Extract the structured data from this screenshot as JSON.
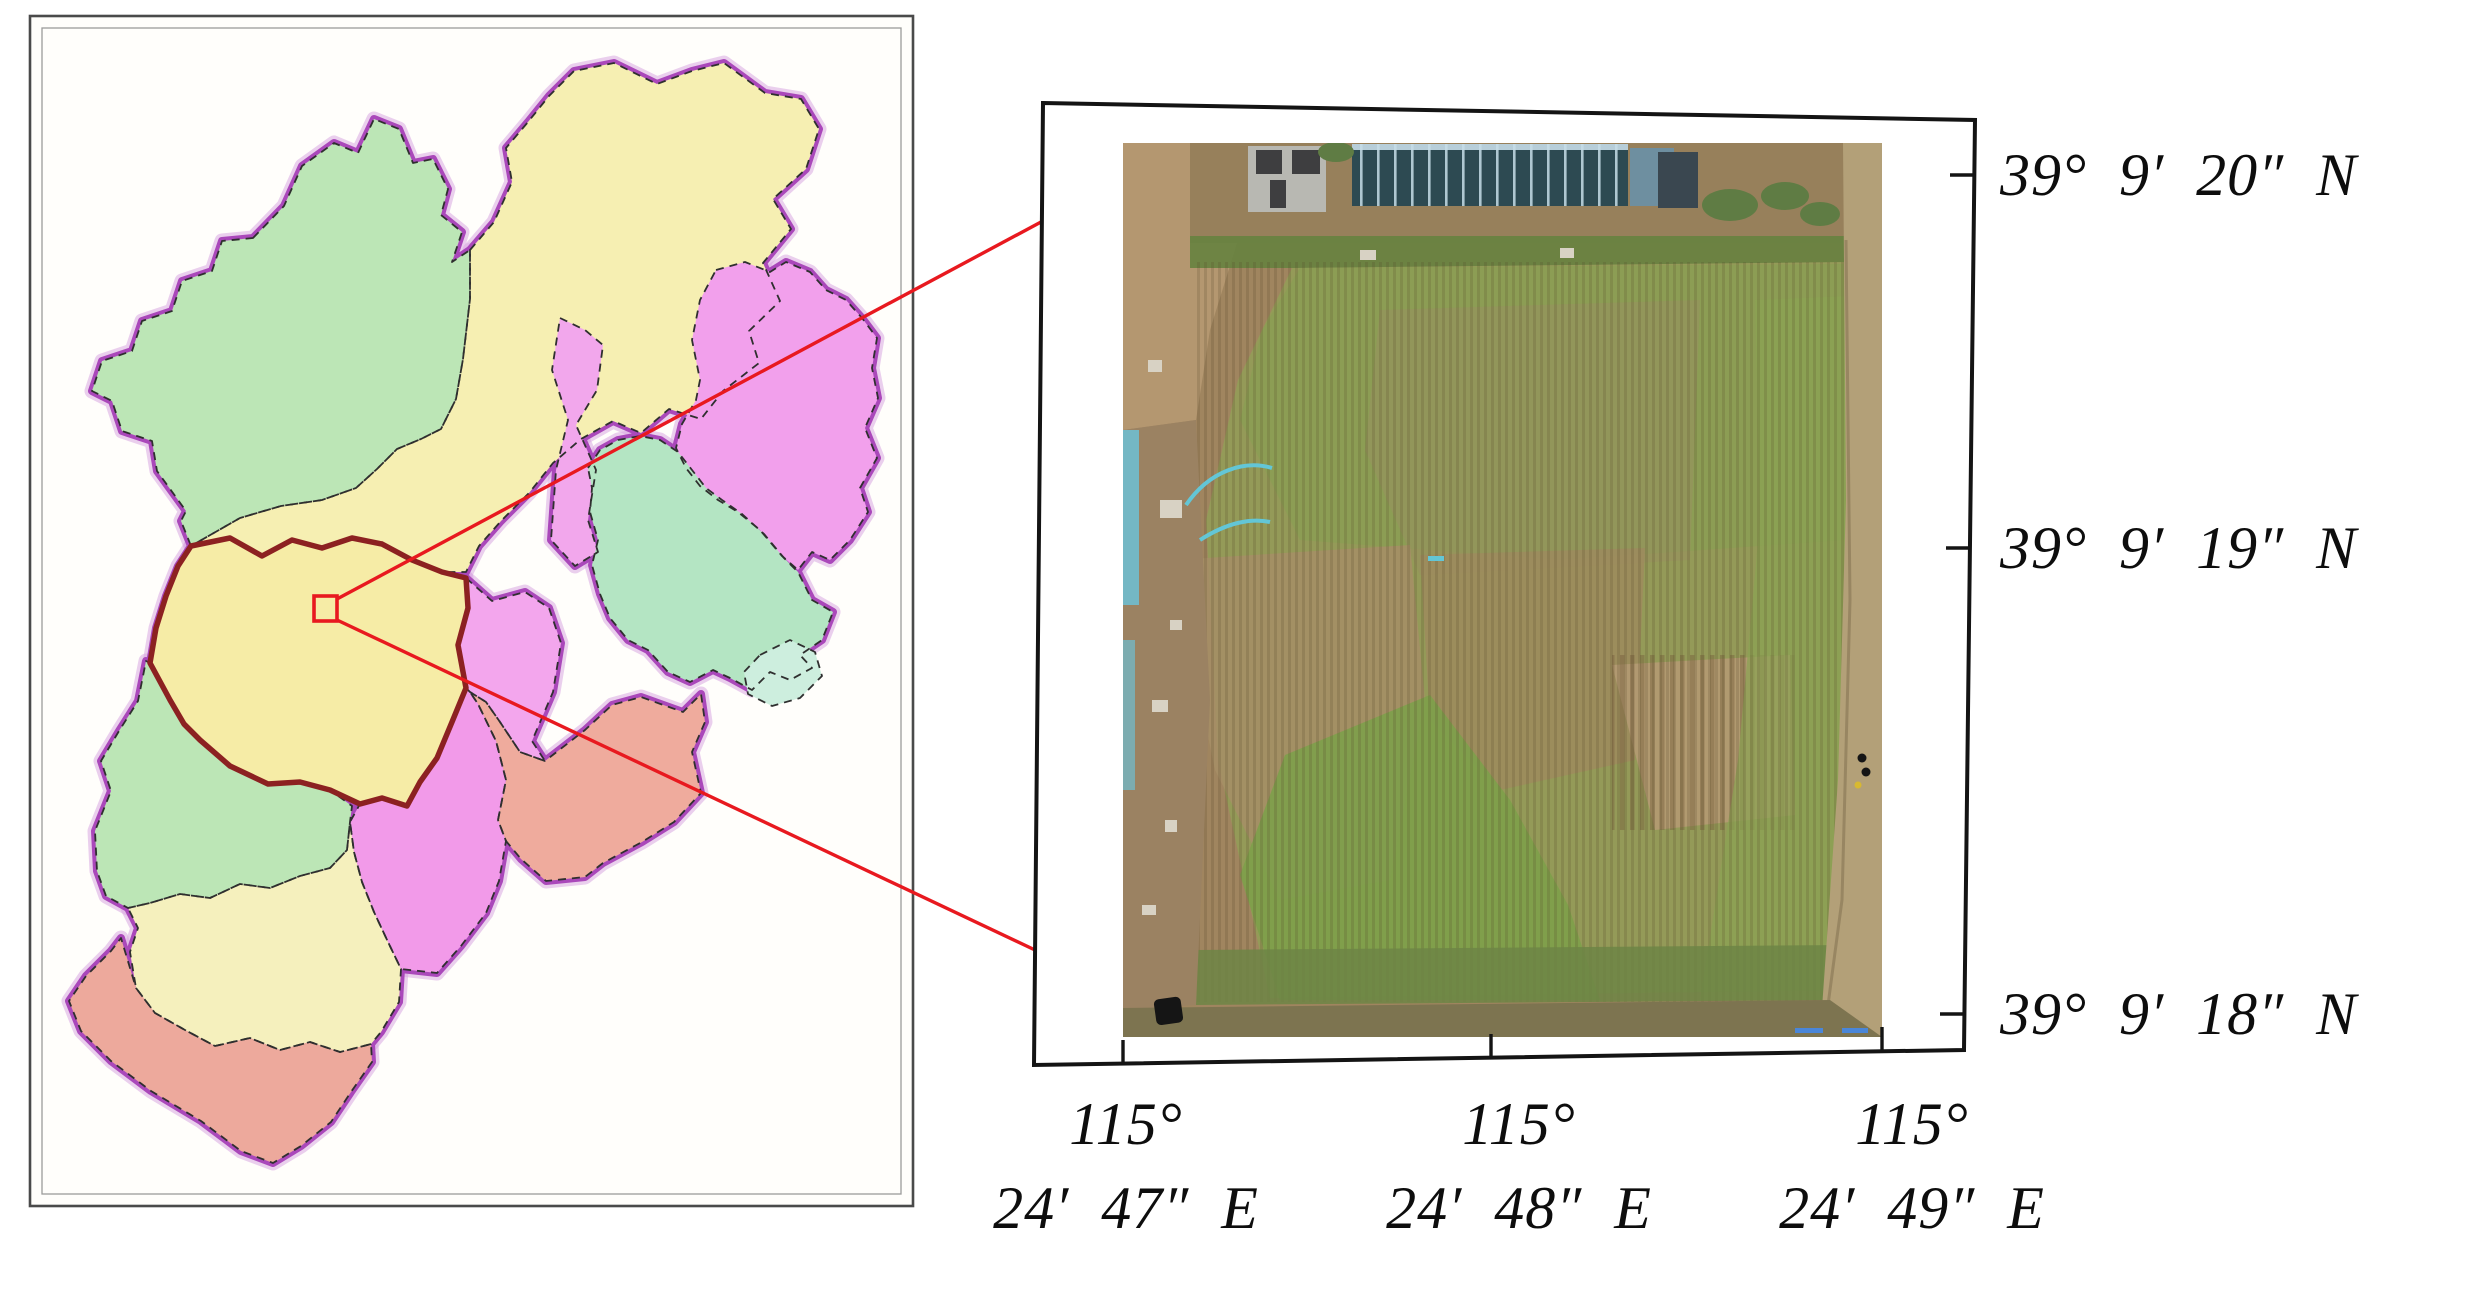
{
  "figure": {
    "kind": "study-area location figure",
    "left": "county administrative map with highlighted study county",
    "right": "UAV orthophoto of experimental field with coordinate grid"
  },
  "palette": {
    "boundary_purple": "#aa48ba",
    "boundary_halo": "#d9a8e2",
    "inner_border_dash": "#2f2f2f",
    "highlight_border": "#8c2121",
    "marker_red": "#e8191f",
    "frame_black": "#141414",
    "panel_border_outer": "#4a4a4a",
    "panel_border_inner": "#9b9b9b",
    "panel_fill": "#fffefb",
    "label_color": "#0d0d0d"
  },
  "left_map": {
    "regions": [
      {
        "id": "northwest-green",
        "color": "#bce6b6"
      },
      {
        "id": "north-yellow",
        "color": "#f6efb2"
      },
      {
        "id": "northeast-sliver-pink",
        "color": "#f2a7ec"
      },
      {
        "id": "northeast-pink",
        "color": "#f2a0ec"
      },
      {
        "id": "northeast-green",
        "color": "#b4e5c3"
      },
      {
        "id": "northeast-green-tail",
        "color": "#cdeede"
      },
      {
        "id": "highlight-yellow",
        "color": "#f6eca6"
      },
      {
        "id": "centereast-pink",
        "color": "#f3a6ed"
      },
      {
        "id": "east-salmon",
        "color": "#efab9d"
      },
      {
        "id": "central-magenta",
        "color": "#f29ae9"
      },
      {
        "id": "west-green",
        "color": "#bce6b6"
      },
      {
        "id": "southwest-yellow",
        "color": "#f5f0bd"
      },
      {
        "id": "south-salmon",
        "color": "#eda99c"
      }
    ]
  },
  "right_panel": {
    "lat_labels": [
      "39° 9′ 20″ N",
      "39° 9′ 19″ N",
      "39° 9′ 18″ N"
    ],
    "lon_labels": [
      {
        "line1": "115°",
        "line2": "24′ 47″ E"
      },
      {
        "line1": "115°",
        "line2": "24′ 48″ E"
      },
      {
        "line1": "115°",
        "line2": "24′ 49″ E"
      }
    ],
    "photo": {
      "dirt": "#a0855f",
      "dirt_light": "#b49770",
      "dirt_top": "#97805b",
      "weeds": "#66823f",
      "field": "#949a58",
      "field_top": "#8b9d54",
      "patch_brown": "#a68e66",
      "patch_brown2": "#9d8a5e",
      "plough": "#b29a72",
      "streak": "#98905e",
      "green_wedge": "#7da04a",
      "green_right": "#8aa252",
      "margin": "#9b8262",
      "teal": "#74b7c4",
      "hose": "#63c6d6",
      "greenhouse": "#2d4a52",
      "greenhouse_light": "#6e8fa0",
      "grid": "#c6dde8",
      "building": "#b8b8b2",
      "building_dark": "#3e3e40",
      "shed": "#3a4750",
      "bush": "#5f7c44",
      "road": "#b3a078",
      "road_edge": "#8d7a58",
      "bottom_strip": "#7d7450",
      "field_edge": "#6d8545",
      "car": "#151515",
      "debris": "#d8d2c4",
      "white_spot": "#e8e6df",
      "blue_mark": "#4a86d8",
      "dot_yellow": "#d8b930"
    }
  }
}
